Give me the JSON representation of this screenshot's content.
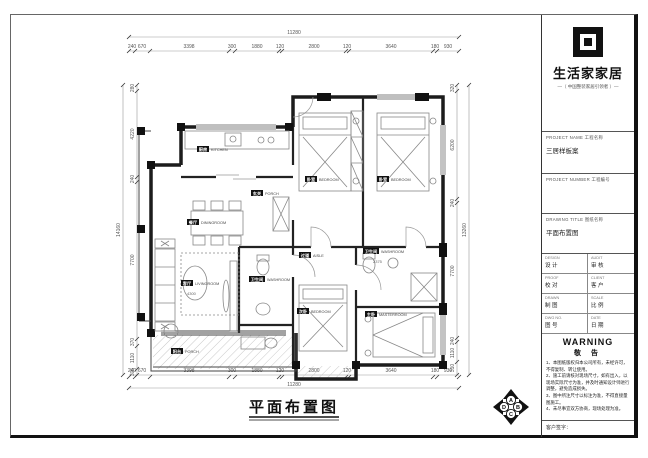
{
  "sheet": {
    "title": "平面布置图",
    "compass": {
      "a": "A",
      "b": "B",
      "c": "C",
      "d": "D"
    }
  },
  "dims": {
    "top_overall": "11280",
    "top": [
      "240",
      "670",
      "3398",
      "300",
      "1880",
      "120",
      "2800",
      "120",
      "3640",
      "180",
      "930"
    ],
    "bottom_overall": "11280",
    "bottom": [
      "240",
      "670",
      "3398",
      "300",
      "1880",
      "120",
      "2800",
      "120",
      "3640",
      "180",
      "930"
    ],
    "left_overall": "14160",
    "left": [
      "280",
      "4220",
      "240",
      "7700",
      "370",
      "1110",
      "305"
    ],
    "right_overall": "13260",
    "right": [
      "320",
      "6200",
      "240",
      "7700",
      "240",
      "1110",
      "310"
    ]
  },
  "rooms": {
    "kitchen": {
      "cn": "厨房",
      "en": "KITCHEN"
    },
    "dining": {
      "cn": "餐厅",
      "en": "DININGROOM"
    },
    "entry": {
      "cn": "玄关",
      "en": "PORCH"
    },
    "bedroom1": {
      "cn": "卧室",
      "en": "BEDROOM"
    },
    "bedroom2": {
      "cn": "卧室",
      "en": "BEDROOM"
    },
    "aisle": {
      "cn": "过道",
      "en": "AISLE"
    },
    "washroom": {
      "cn": "卫生间",
      "en": "WASHROOM",
      "size": "2375"
    },
    "wc": {
      "cn": "卫生间",
      "en": "WASHROOM"
    },
    "living": {
      "cn": "客厅",
      "en": "LIVINGROOM",
      "size": "4300"
    },
    "bedroom3": {
      "cn": "次卧",
      "en": "BEDROOM"
    },
    "master": {
      "cn": "主卧",
      "en": "MASTERROOM"
    },
    "balcony": {
      "cn": "阳台",
      "en": "PORCH"
    }
  },
  "titleblock": {
    "brand": "生活家家居",
    "slogan": "—（ 中国整装家居引领者 ）—",
    "fields": [
      {
        "label": "PROJECT NAME 工程名称",
        "value": "三居样板案"
      },
      {
        "label": "PROJECT NUMBER 工程编号",
        "value": ""
      },
      {
        "label": "DRAWING TITLE 图纸名称",
        "value": "平面布置图"
      }
    ],
    "grid": [
      {
        "en": "DESIGN",
        "cn": "设 计"
      },
      {
        "en": "AUDIT",
        "cn": "审 核"
      },
      {
        "en": "PROOF",
        "cn": "校 对"
      },
      {
        "en": "CLIENT",
        "cn": "客 户"
      },
      {
        "en": "DRAWN",
        "cn": "制 图"
      },
      {
        "en": "SCALE",
        "cn": "比 例"
      },
      {
        "en": "DWG NO.",
        "cn": "图 号"
      },
      {
        "en": "DATE",
        "cn": "日 期"
      }
    ],
    "warning_en": "WARNING",
    "warning_cn": "敬 告",
    "notes": [
      "1、本图纸版权归本公司所有，未经许可，不得复制、转让使用。",
      "2、施工前请核对现场尺寸，如有出入，以现场实际尺寸为准，并及时通知设计师进行调整，避免造成损失。",
      "3、图中所注尺寸以标注为准，不得直接量图施工。",
      "4、未尽事宜双方协商，现场处理为准。"
    ],
    "sign_label": "客户签字："
  }
}
